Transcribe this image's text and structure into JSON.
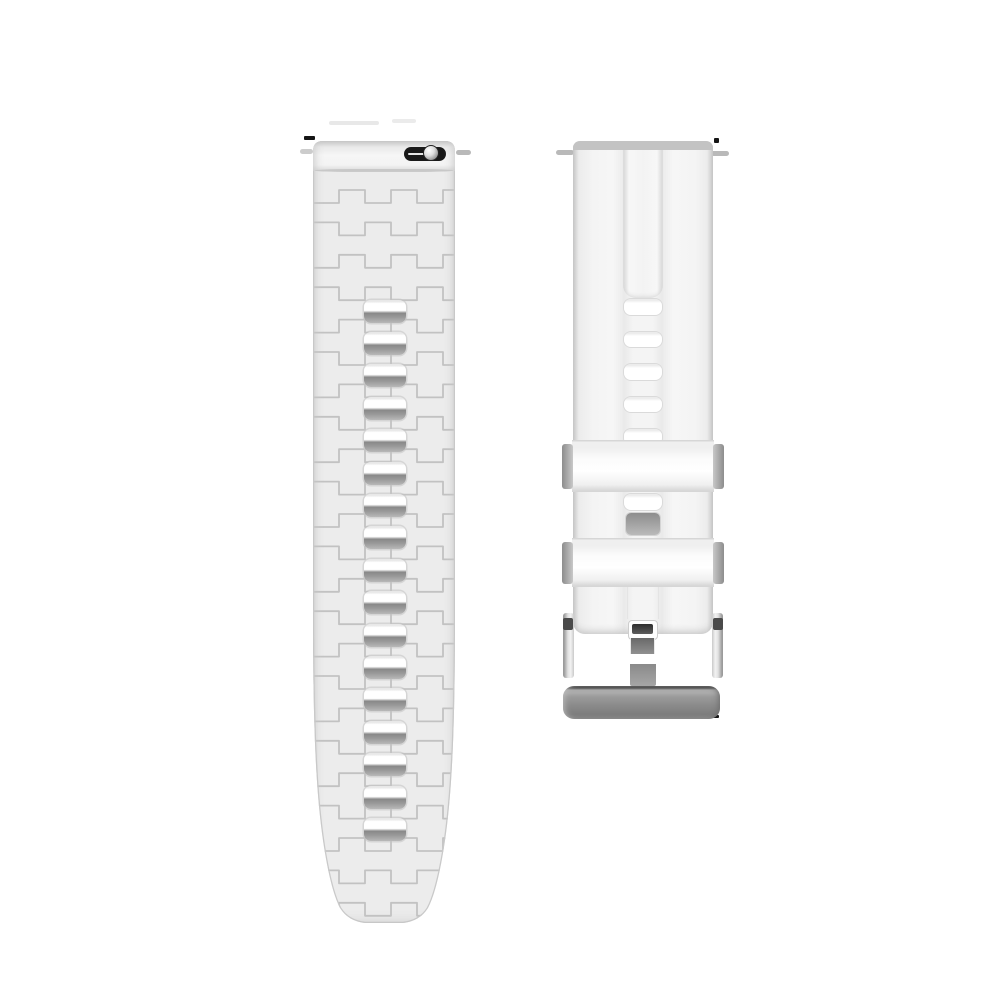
{
  "scene": {
    "subject": "white silicone quick-release watch strap, two pieces on white background",
    "background": "#ffffff"
  },
  "colors": {
    "page-bg": "#ffffff",
    "strap-fill": "#ececec",
    "strap-fill-light": "#f3f3f3",
    "texture-line": "#c2c2c2",
    "edge-line": "#cdcdcd",
    "hole-shadow": "#8d8d8d",
    "spring-bar-black": "#191919",
    "knob-silver": "#d9d9d9",
    "keeper-tab-gray": "#a0a0a0",
    "buckle-bar-gray": "#868686",
    "tang-gray": "#7a7a7a"
  },
  "left_strap": {
    "part": "adjustment-hole band with quick-release spring bar",
    "holes": {
      "count": 17,
      "first_top": 158.5,
      "pitch": 32.4,
      "x": 51,
      "width": 41.5,
      "height": 23,
      "radius": 7
    },
    "texture": {
      "start_y": 62,
      "row_pitch": 32.4,
      "period": 52,
      "amplitude": 13,
      "stroke_width": 1.8
    }
  },
  "right_strap": {
    "part": "buckle band with two keeper loops and silver pin buckle",
    "holes": {
      "x": 51,
      "width": 38,
      "height": 15.5,
      "radius": 7,
      "tops": [
        158,
        190.5,
        223,
        255.5,
        288,
        353
      ]
    },
    "keeper_count": 2
  }
}
